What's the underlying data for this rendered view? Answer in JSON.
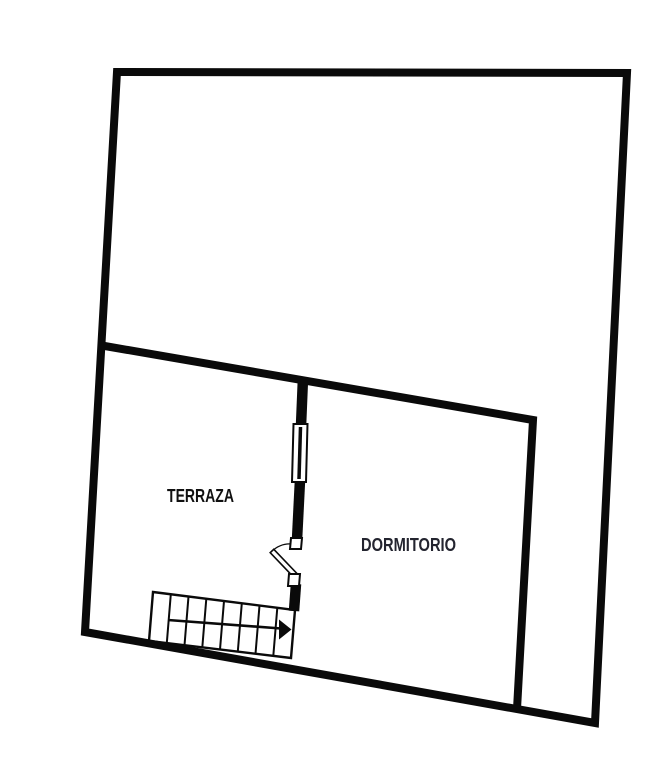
{
  "canvas": {
    "width": 663,
    "height": 768,
    "background_color": "#ffffff",
    "wall_color": "#0a0a0a"
  },
  "rooms": {
    "terraza": {
      "label": "TERRAZA"
    },
    "dormitorio": {
      "label": "DORMITORIO"
    }
  },
  "features": {
    "window": {
      "name": "window-on-divider-wall"
    },
    "door": {
      "name": "door-swinging-into-terraza"
    },
    "staircase": {
      "name": "staircase-with-direction-arrow",
      "step_cells": 8,
      "arrow_direction": "right"
    }
  },
  "geometry": {
    "outer_wall_points": "117,72 627,73 595,723 85,632",
    "interior_wall_points": "99,345 533,420 517,709",
    "divider_upper_points": "303,378 301,426",
    "divider_mid_points": "300,480 297,540",
    "divider_lower_points": "296,584 294,611",
    "window_outline_points": "293.5,424 307.5,424 306,482 292,482",
    "window_pane_points": "300.5,427 299,479",
    "door_jamb_top_points": "291,538 302,538 301,549 290,549",
    "door_jamb_bottom_points": "289,574 300,574 299,586 288,586",
    "door_leaf_points": "273.8,549.3 296.8,573.3 293.2,576.7 270.2,552.7",
    "door_swing_path": "M 297,545 Q 283,541 271.5,551.5",
    "stair_outline_points": "153,592 295,610 291,658 149,641",
    "stair_treads_path": "M170.8,594.3 L166.8,643.1 M188.5,596.5 L184.5,645.3 M206.3,598.8 L202.3,647.4 M224,601 L220,649.5 M241.8,603.3 L237.8,651.6 M259.5,605.5 L255.5,653.8 M277.3,607.8 L273.3,655.9",
    "stair_arrow_points": "168,620 281,628.5",
    "stair_arrowhead_points": "279,619.5 291.5,629.5 279,639.5"
  }
}
